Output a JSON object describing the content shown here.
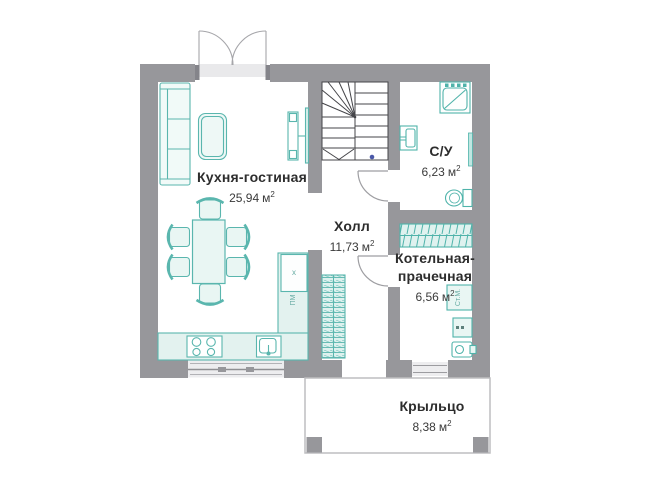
{
  "plan": {
    "meta": {
      "unit_base": "м",
      "unit_exp": "2"
    },
    "rooms": {
      "kitchen_living": {
        "name": "Кухня-гостиная",
        "area": "25,94"
      },
      "hall": {
        "name": "Холл",
        "area": "11,73"
      },
      "bathroom": {
        "name": "С/У",
        "area": "6,23"
      },
      "boiler_laundry": {
        "name_line1": "Котельная-",
        "name_line2": "прачечная",
        "area": "6,56"
      },
      "porch": {
        "name": "Крыльцо",
        "area": "8,38"
      }
    },
    "appliances": {
      "washing_machine": "Ст.М.",
      "dishwasher": "ПМ",
      "fridge_mark": "х"
    },
    "colors": {
      "wall_gray": "#97979b",
      "fixture_teal": "#4fb3aa",
      "stair_line": "#454549",
      "label_text": "#2d2d2d"
    }
  }
}
